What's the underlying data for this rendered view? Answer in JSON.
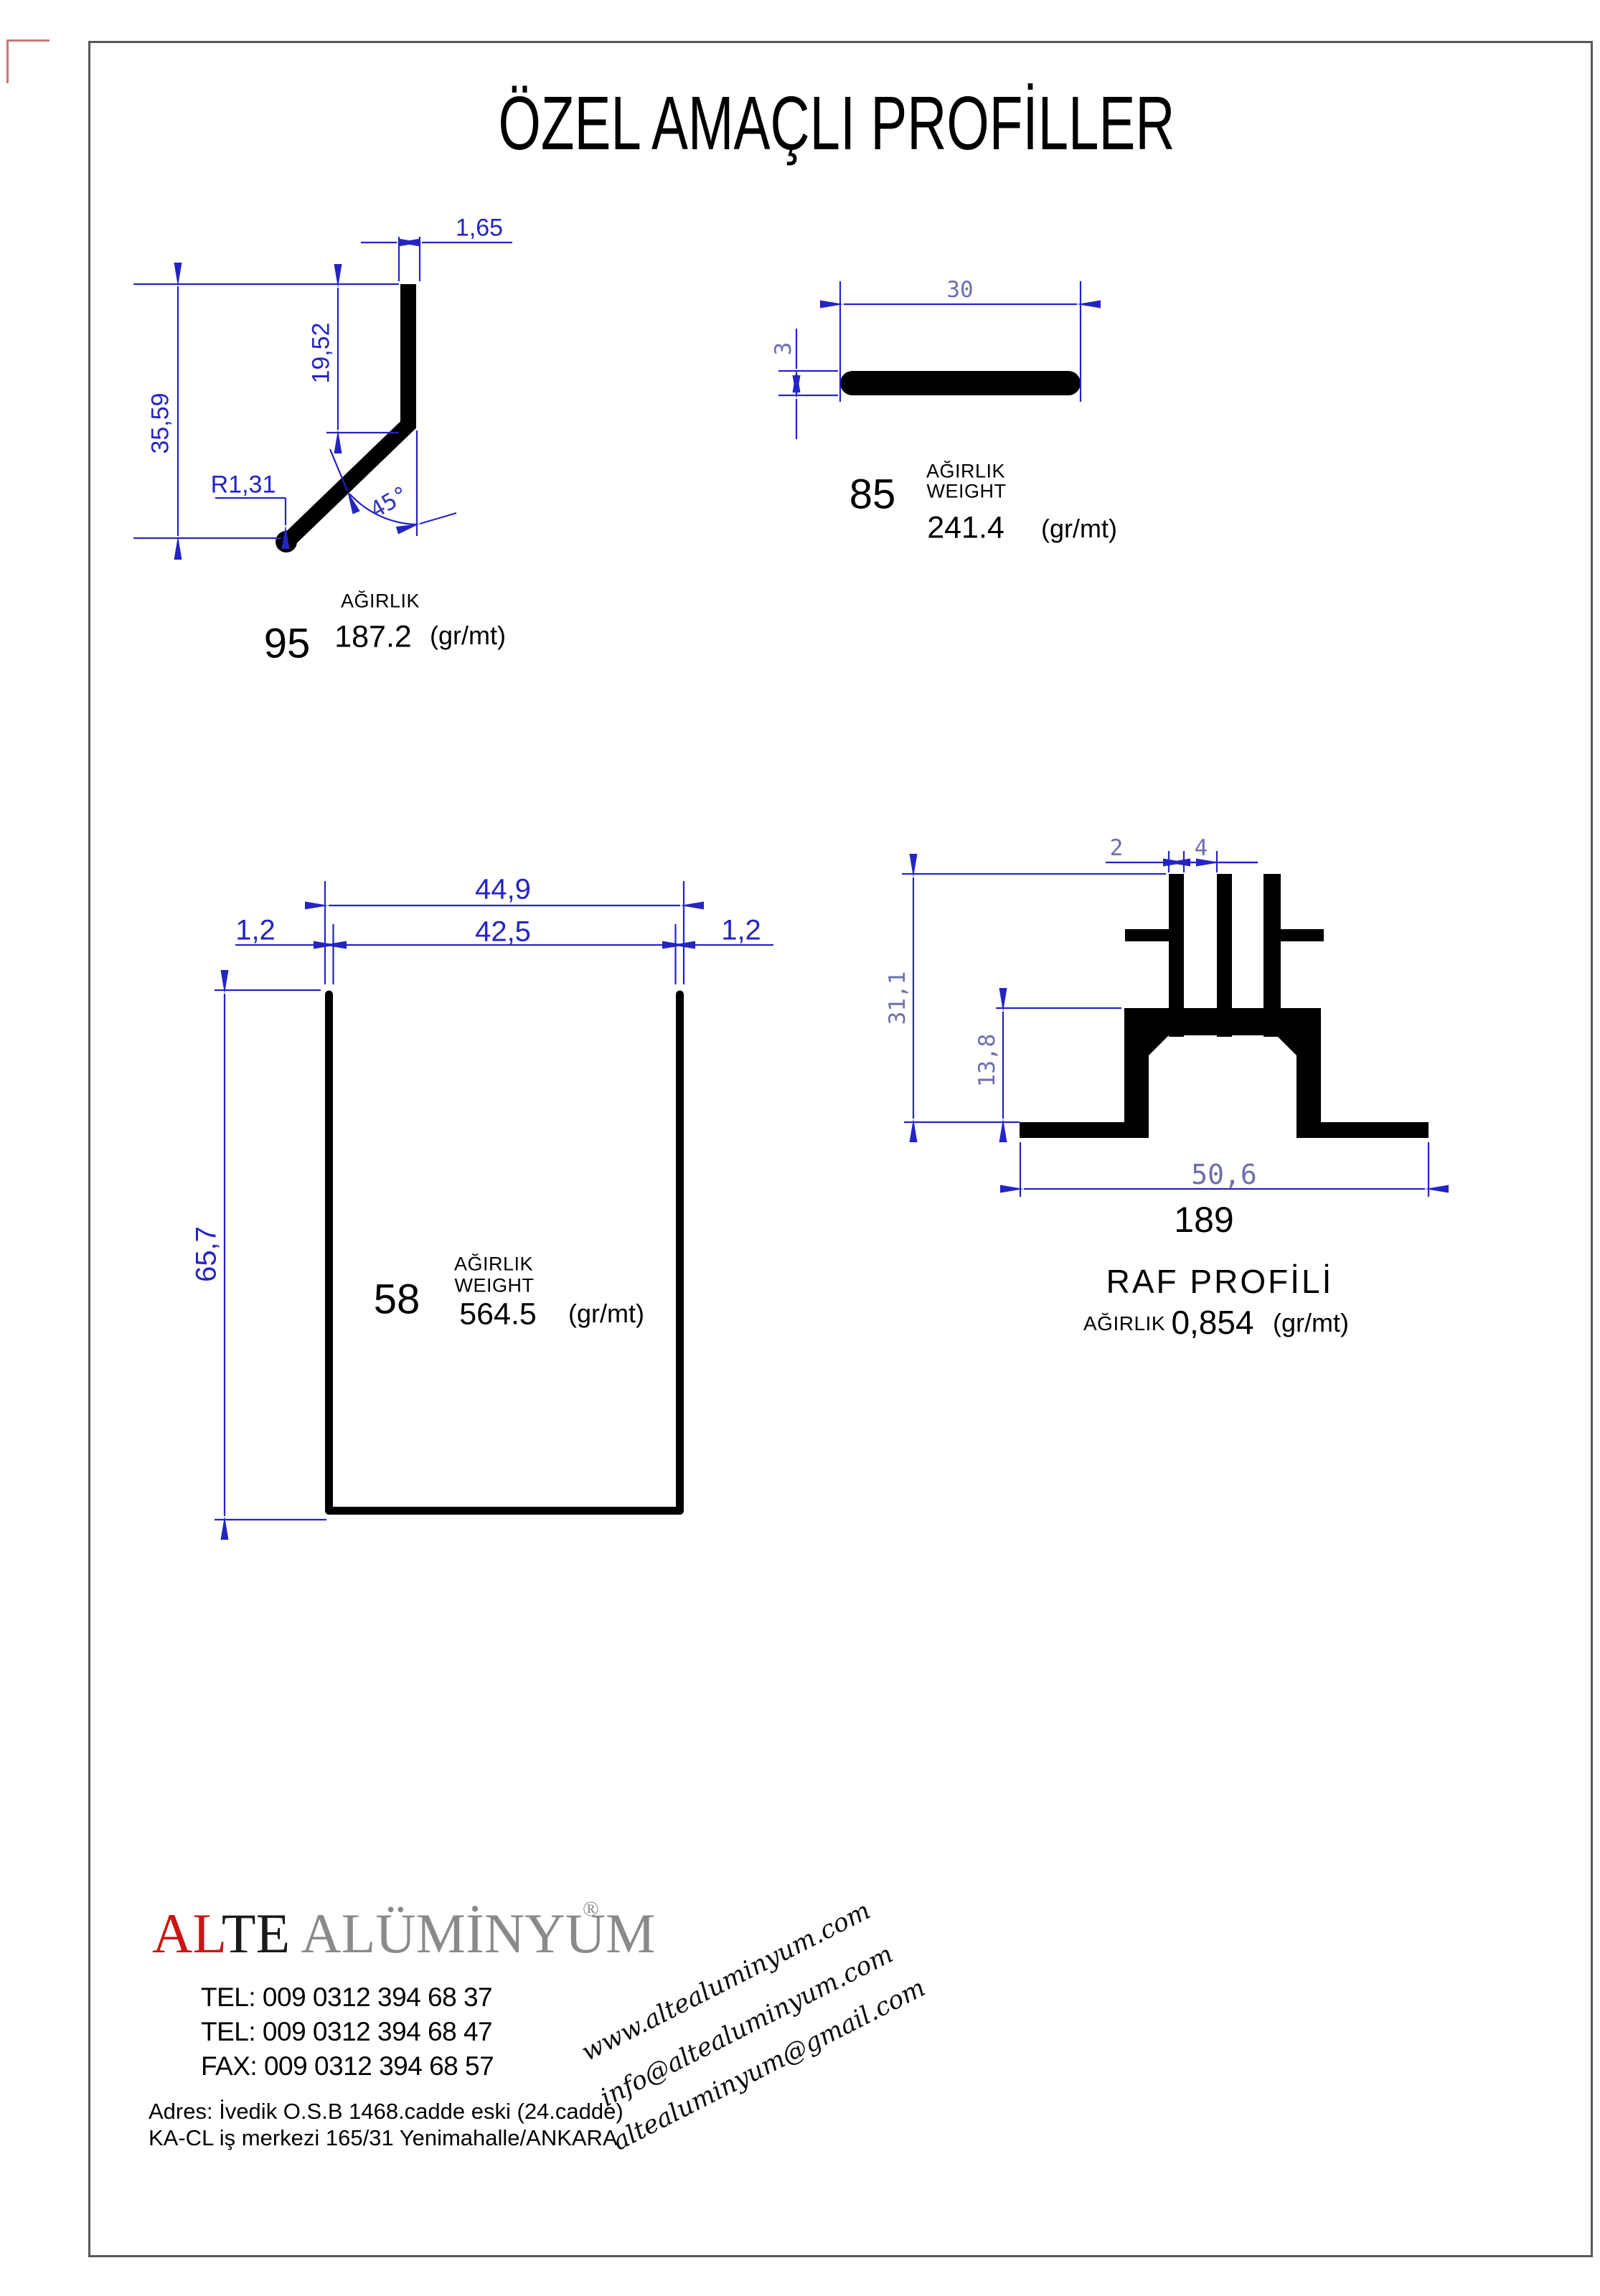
{
  "page": {
    "title": "ÖZEL AMAÇLI PROFİLLER"
  },
  "colors": {
    "dimension_blue": "#2424c4",
    "dimension_muted_blue": "#6e6eae",
    "profile_black": "#000000",
    "frame_gray": "#585858",
    "corner_mark_red": "#c87878",
    "logo_red": "#cc1414",
    "logo_gray": "#8a8a8a"
  },
  "profiles": [
    {
      "code": "95",
      "weight_label": "AĞIRLIK",
      "weight_value": "187.2",
      "unit": "(gr/mt)",
      "dims": {
        "top_width": "1,65",
        "inner_height": "19,52",
        "overall_height": "35,59",
        "radius": "R1,31",
        "angle": "45°"
      }
    },
    {
      "code": "85",
      "weight_label": "AĞIRLIK",
      "weight_label_en": "WEIGHT",
      "weight_value": "241.4",
      "unit": "(gr/mt)",
      "dims": {
        "width": "30",
        "thickness": "3"
      }
    },
    {
      "code": "58",
      "weight_label": "AĞIRLIK",
      "weight_label_en": "WEIGHT",
      "weight_value": "564.5",
      "unit": "(gr/mt)",
      "dims": {
        "outer_width": "44,9",
        "inner_width": "42,5",
        "wall_left": "1,2",
        "wall_right": "1,2",
        "height": "65,7"
      }
    },
    {
      "code": "189",
      "name": "RAF PROFİLİ",
      "weight_label": "AĞIRLIK",
      "weight_value": "0,854",
      "unit": "(gr/mt)",
      "dims": {
        "fin_thickness": "2",
        "fin_gap": "4",
        "overall_height": "31,1",
        "lower_height": "13,8",
        "base_width": "50,6"
      }
    }
  ],
  "footer": {
    "brand": {
      "part1": "AL",
      "part2": "TE",
      "part3": " ALÜMİNYUM",
      "registered": "®"
    },
    "contacts": [
      "TEL: 009 0312 394 68 37",
      "TEL: 009 0312 394 68 47",
      "FAX: 009 0312 394 68 57"
    ],
    "address_lines": [
      "Adres: İvedik O.S.B 1468.cadde eski (24.cadde)",
      "KA-CL iş merkezi 165/31 Yenimahalle/ANKARA"
    ],
    "links": [
      "www.altealuminyum.com",
      "info@altealuminyum.com",
      "altealuminyum@gmail.com"
    ]
  }
}
